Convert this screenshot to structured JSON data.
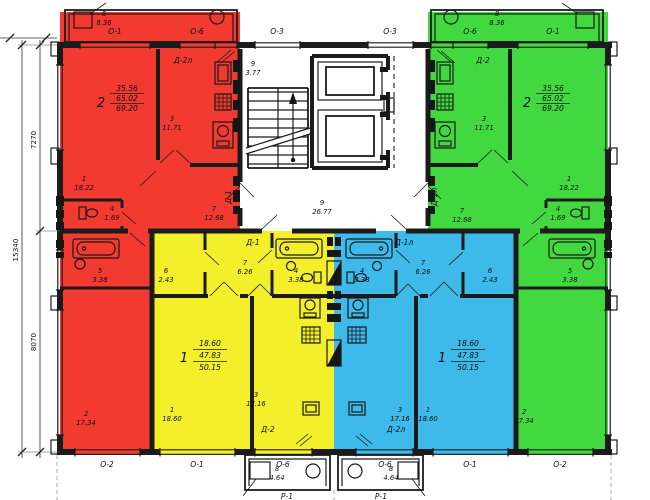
{
  "colors": {
    "red": "#f23a30",
    "yellow": "#f3ef2b",
    "blue": "#3db9ea",
    "green": "#41d93f"
  },
  "window_marks": {
    "top": [
      "О-1",
      "О-6",
      "О-3",
      "О-3",
      "О-6",
      "О-1"
    ],
    "bottom": [
      "О-2",
      "О-1",
      "О-6",
      "О-6",
      "О-1",
      "О-2"
    ]
  },
  "porch_marks": {
    "left": "Р-1",
    "right": "Р-1"
  },
  "dimensions": {
    "upper": "7270",
    "lower": "8070",
    "total": "15340"
  },
  "core": {
    "landing": {
      "n": "9",
      "a": "3.77"
    },
    "lobby": {
      "n": "9",
      "a": "26.77"
    }
  },
  "apartments": {
    "red": {
      "number": "2",
      "living": "35.56",
      "useful": "65.02",
      "total": "69.20",
      "entry_door": "Д-1",
      "balcony_door": "Д-2л",
      "rooms": {
        "r1": {
          "n": "1",
          "a": "18.22"
        },
        "r2": {
          "n": "2",
          "a": "17.34"
        },
        "r3": {
          "n": "3",
          "a": "11.71"
        },
        "r4": {
          "n": "4",
          "a": "1.69"
        },
        "r5": {
          "n": "5",
          "a": "3.38"
        },
        "r7": {
          "n": "7",
          "a": "12.68"
        },
        "r8": {
          "n": "8",
          "a": "8.36"
        }
      }
    },
    "green": {
      "number": "2",
      "living": "35.56",
      "useful": "65.02",
      "total": "69.20",
      "entry_door": "Д-1л",
      "balcony_door": "Д-2",
      "rooms": {
        "r1": {
          "n": "1",
          "a": "18.22"
        },
        "r2": {
          "n": "2",
          "a": "17.34"
        },
        "r3": {
          "n": "3",
          "a": "11.71"
        },
        "r4": {
          "n": "4",
          "a": "1.69"
        },
        "r5": {
          "n": "5",
          "a": "3.38"
        },
        "r7": {
          "n": "7",
          "a": "12.68"
        },
        "r8": {
          "n": "8",
          "a": "8.36"
        }
      }
    },
    "yellow": {
      "number": "1",
      "living": "18.60",
      "useful": "47.83",
      "total": "50.15",
      "entry_door": "Д-1",
      "balcony_door": "Д-2",
      "rooms": {
        "r1": {
          "n": "1",
          "a": "18.60"
        },
        "r3": {
          "n": "3",
          "a": "17.16"
        },
        "r4": {
          "n": "4",
          "a": "3.38"
        },
        "r6": {
          "n": "6",
          "a": "2.43"
        },
        "r7": {
          "n": "7",
          "a": "6.26"
        },
        "r8": {
          "n": "8",
          "a": "4.64"
        }
      }
    },
    "blue": {
      "number": "1",
      "living": "18.60",
      "useful": "47.83",
      "total": "50.15",
      "entry_door": "Д-1л",
      "balcony_door": "Д-2л",
      "rooms": {
        "r1": {
          "n": "1",
          "a": "18.60"
        },
        "r3": {
          "n": "3",
          "a": "17.16"
        },
        "r4": {
          "n": "4",
          "a": "3.38"
        },
        "r6": {
          "n": "6",
          "a": "2.43"
        },
        "r7": {
          "n": "7",
          "a": "6.26"
        },
        "r8": {
          "n": "8",
          "a": "4.64"
        }
      }
    }
  }
}
